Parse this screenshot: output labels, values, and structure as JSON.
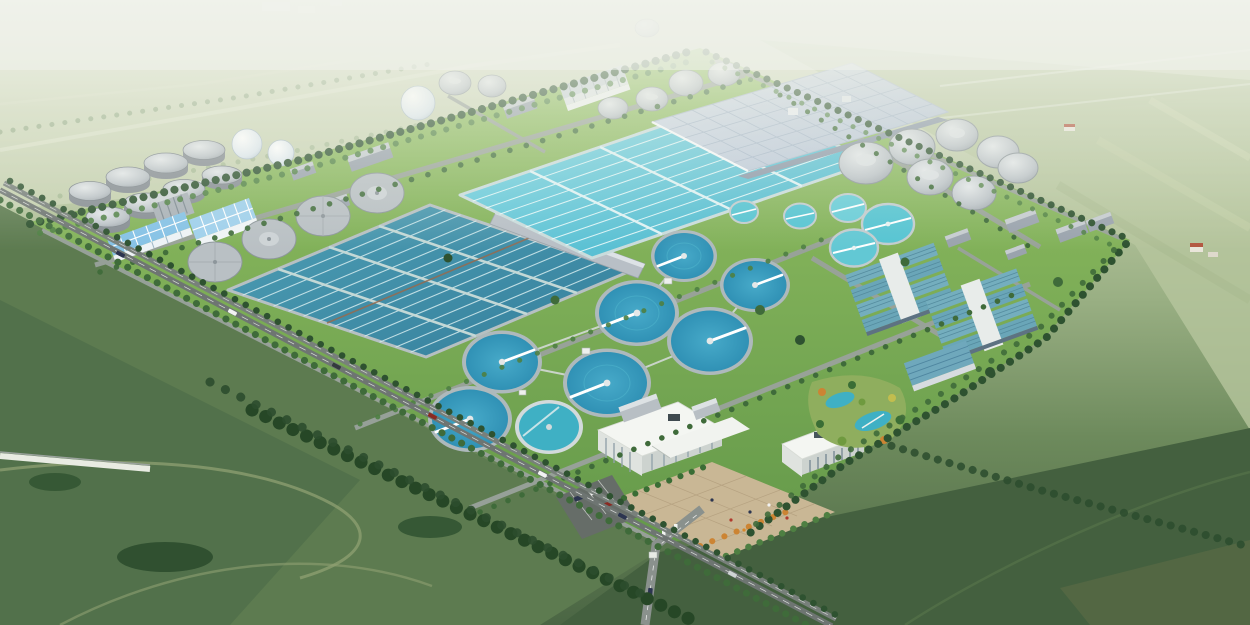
{
  "scene": {
    "title": "Wastewater treatment plant campus — aerial rendering",
    "description": "Aerial isometric architectural rendering of a large wastewater treatment plant set in green farmland: clusters of gray digester tanks and white gas spheres at the upper left, two huge rectangular aeration basins (one deep teal with serpentine lanes, one bright cyan) in the center, a large pale blue-gray covered membrane building at the upper right, rows of circular clarifiers with white scraper bridges in the lower center, industrial halls with teal striped roofs on the right, and a white-roofed administration complex with a paved plaza, round pond, gardens and a tree-lined entrance boulevard at the bottom.",
    "view": "high-angle aerial, isometric-style perspective",
    "surroundings": "hazy pale-green fields to the north, dark green farmland with hedgerows and dirt paths to the south"
  },
  "colors": {
    "hazeTop": "#eef1e6",
    "distGreen": "#c2cfad",
    "distGreen2": "#aabd92",
    "fieldMid": "#7b9a68",
    "fieldDark": "#4c6845",
    "fieldDarker": "#40583c",
    "lawn": "#82b656",
    "lawnDark": "#619947",
    "treeDark": "#2e5230",
    "treeMid": "#3f6b3a",
    "treeLight": "#4e7f42",
    "road": "#757c76",
    "roadLight": "#9aa29c",
    "pathTan": "#93a374",
    "waterDark": "#4192ac",
    "waterDeep": "#2e7d99",
    "waterBright": "#5ec9db",
    "laneLight": "#d6ecef",
    "clarifier": "#2e94ba",
    "clarifierRim": "#aeb9bc",
    "tealTank": "#55c4d2",
    "concrete": "#b8bfc4",
    "concreteDark": "#8d969b",
    "roofBlue": "#85c2e6",
    "roofGray": "#9aa5b0",
    "bigRoof": "#c6d0de",
    "bigRoofLine": "#9fb0c4",
    "whiteRoof": "#f4f6f2",
    "adminFace": "#cfd5d1",
    "glass": "#41505a",
    "plaza": "#c9b795",
    "plazaLine": "#b29e7d",
    "parking": "#666d68",
    "pond": "#3fb0c4",
    "orangeTree": "#cc8433",
    "yellowTree": "#c2bd4e",
    "sphere": "#e6edf2",
    "domeGray": "#c6ccd0",
    "tealRoof": "#74aebe",
    "tealRoofLine": "#52899c",
    "farmRoof": "#b2563f"
  },
  "inventory": {
    "digester_tanks": 8,
    "gas_spheres": 3,
    "flat_covered_tanks_left_row": 4,
    "small_covered_tanks_top": 6,
    "covered_tank_cluster_right": 7,
    "aeration_basins": 2,
    "covered_membrane_building": 1,
    "circular_clarifiers": 7,
    "small_teal_water_tanks": 5,
    "industrial_hall_complexes": 2,
    "admin_buildings": 2,
    "round_pond": 1,
    "blue_roof_buildings": 2,
    "entrance_boulevard": 1
  }
}
